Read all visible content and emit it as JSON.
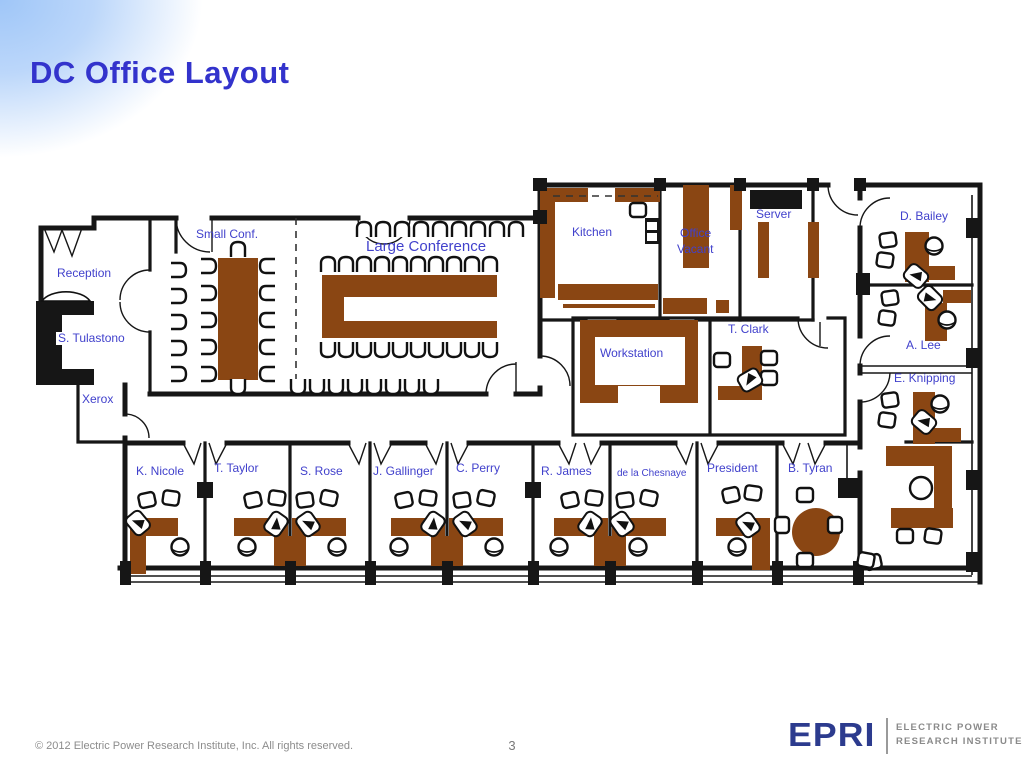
{
  "header": {
    "title": "DC Office Layout"
  },
  "floorplan": {
    "rooms": [
      {
        "id": "reception",
        "label": "Reception",
        "x": 29,
        "y": 97
      },
      {
        "id": "s-tulastono",
        "label": "S. Tulastono",
        "x": 28,
        "y": 162,
        "bg": true
      },
      {
        "id": "xerox",
        "label": "Xerox",
        "x": 54,
        "y": 223
      },
      {
        "id": "small-conf",
        "label": "Small Conf.",
        "x": 168,
        "y": 58
      },
      {
        "id": "large-conference",
        "label": "Large Conference",
        "x": 338,
        "y": 70,
        "size": "big"
      },
      {
        "id": "kitchen",
        "label": "Kitchen",
        "x": 544,
        "y": 56
      },
      {
        "id": "office-vacant-line1",
        "label": "Office",
        "x": 652,
        "y": 57
      },
      {
        "id": "office-vacant-line2",
        "label": "Vacant",
        "x": 649,
        "y": 73
      },
      {
        "id": "server",
        "label": "Server",
        "x": 728,
        "y": 38
      },
      {
        "id": "d-bailey",
        "label": "D. Bailey",
        "x": 872,
        "y": 40
      },
      {
        "id": "a-lee",
        "label": "A. Lee",
        "x": 878,
        "y": 169
      },
      {
        "id": "e-knipping",
        "label": "E. Knipping",
        "x": 866,
        "y": 202
      },
      {
        "id": "t-clark",
        "label": "T. Clark",
        "x": 700,
        "y": 153
      },
      {
        "id": "workstation",
        "label": "Workstation",
        "x": 572,
        "y": 177
      },
      {
        "id": "k-nicole",
        "label": "K. Nicole",
        "x": 108,
        "y": 295
      },
      {
        "id": "t-taylor",
        "label": "T. Taylor",
        "x": 186,
        "y": 292
      },
      {
        "id": "s-rose",
        "label": "S. Rose",
        "x": 272,
        "y": 295
      },
      {
        "id": "j-gallinger",
        "label": "J. Gallinger",
        "x": 345,
        "y": 295
      },
      {
        "id": "c-perry",
        "label": "C. Perry",
        "x": 428,
        "y": 292
      },
      {
        "id": "r-james",
        "label": "R. James",
        "x": 513,
        "y": 295
      },
      {
        "id": "de-la-chesnaye",
        "label": "de la Chesnaye",
        "x": 589,
        "y": 297,
        "size": "small"
      },
      {
        "id": "president",
        "label": "President",
        "x": 679,
        "y": 292
      },
      {
        "id": "b-tyran",
        "label": "B. Tyran",
        "x": 760,
        "y": 292
      }
    ]
  },
  "footer": {
    "copyright": "© 2012 Electric Power Research Institute, Inc. All rights reserved.",
    "page_number": "3"
  },
  "logo": {
    "wordmark": "EPRI",
    "line1": "ELECTRIC POWER",
    "line2": "RESEARCH INSTITUTE"
  },
  "colors": {
    "title_blue": "#3333cc",
    "label_blue": "#4141cc",
    "furniture_brown": "#8a4613",
    "logo_navy": "#2c3b8e"
  }
}
